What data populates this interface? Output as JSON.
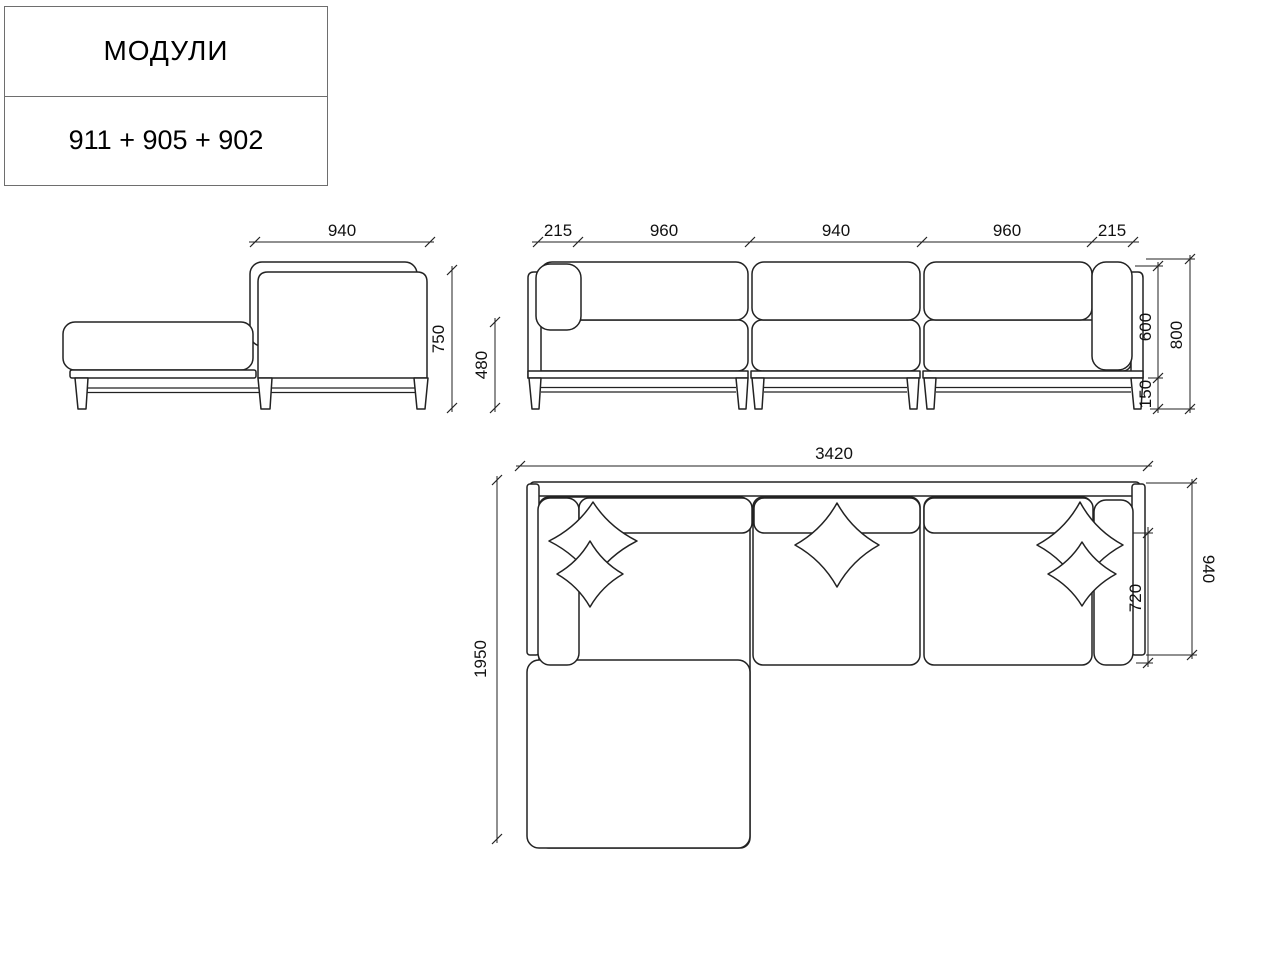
{
  "colors": {
    "line": "#222222",
    "border": "#6e6e6e",
    "background": "#ffffff"
  },
  "title_block": {
    "title": "МОДУЛИ",
    "modules_code": "911 + 905 + 902"
  },
  "views": {
    "side": {
      "dims": {
        "depth": "940",
        "height": "750"
      }
    },
    "front": {
      "dims": {
        "arm_left": "215",
        "seat_left": "960",
        "seat_mid": "940",
        "seat_right": "960",
        "arm_right": "215",
        "seat_height": "480",
        "back_height": "600",
        "total_height": "800",
        "leg_height": "150"
      }
    },
    "top": {
      "dims": {
        "total_length": "3420",
        "total_depth": "1950",
        "seat_depth": "720",
        "module_depth": "940"
      }
    }
  }
}
